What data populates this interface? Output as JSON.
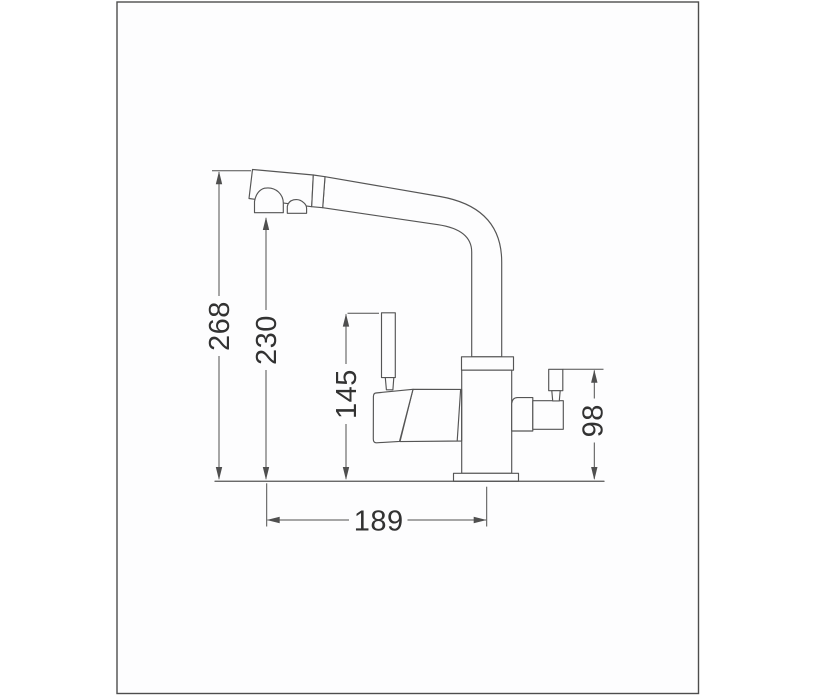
{
  "frame": {
    "stroke_color": "#4d4d4d",
    "background": "#fdfdfe"
  },
  "drawing": {
    "line_color": "#555555",
    "dim_line_color": "#4f4f4f",
    "text_color": "#323232",
    "dimensions": {
      "overall_height": "268",
      "spout_outlet_height": "230",
      "handle_lever_height": "145",
      "side_lever_height": "98",
      "spout_reach": "189"
    }
  }
}
